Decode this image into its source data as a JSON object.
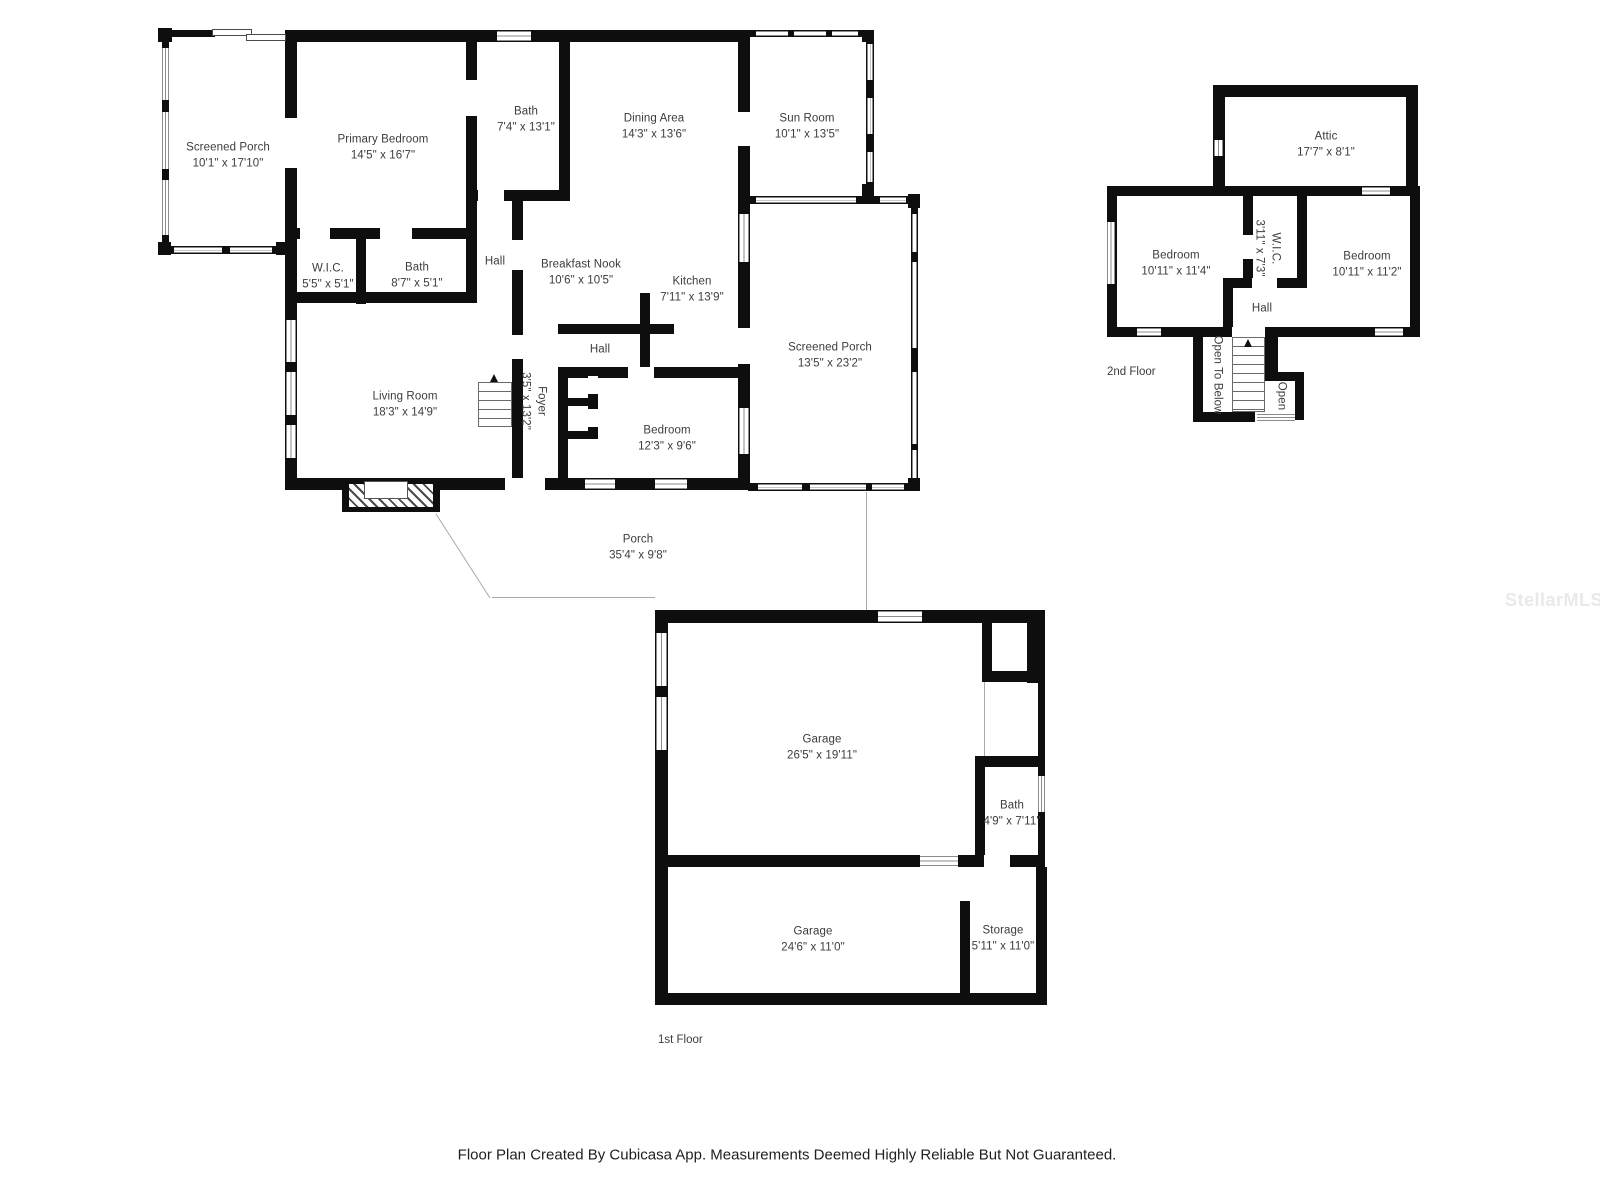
{
  "meta": {
    "watermark": "StellarMLS",
    "footer": "Floor Plan Created By Cubicasa App. Measurements Deemed Highly Reliable But Not Guaranteed."
  },
  "floors": [
    {
      "label": "1st Floor",
      "rooms": [
        {
          "name": "Screened Porch",
          "dims": "10'1\" x 17'10\""
        },
        {
          "name": "Primary Bedroom",
          "dims": "14'5\" x 16'7\""
        },
        {
          "name": "Bath",
          "dims": "7'4\" x 13'1\""
        },
        {
          "name": "Dining Area",
          "dims": "14'3\" x 13'6\""
        },
        {
          "name": "Sun Room",
          "dims": "10'1\" x 13'5\""
        },
        {
          "name": "W.I.C.",
          "dims": "5'5\" x 5'1\""
        },
        {
          "name": "Bath",
          "dims": "8'7\" x 5'1\""
        },
        {
          "name": "Hall",
          "dims": ""
        },
        {
          "name": "Breakfast Nook",
          "dims": "10'6\" x 10'5\""
        },
        {
          "name": "Kitchen",
          "dims": "7'11\" x 13'9\""
        },
        {
          "name": "Screened Porch",
          "dims": "13'5\" x 23'2\""
        },
        {
          "name": "Living Room",
          "dims": "18'3\" x 14'9\""
        },
        {
          "name": "Foyer",
          "dims": "3'5\" x 13'2\""
        },
        {
          "name": "Hall",
          "dims": ""
        },
        {
          "name": "Bedroom",
          "dims": "12'3\" x 9'6\""
        },
        {
          "name": "Porch",
          "dims": "35'4\" x 9'8\""
        },
        {
          "name": "Garage",
          "dims": "26'5\" x 19'11\""
        },
        {
          "name": "Bath",
          "dims": "4'9\" x 7'11\""
        },
        {
          "name": "Garage",
          "dims": "24'6\" x 11'0\""
        },
        {
          "name": "Storage",
          "dims": "5'11\" x 11'0\""
        }
      ]
    },
    {
      "label": "2nd Floor",
      "rooms": [
        {
          "name": "Attic",
          "dims": "17'7\" x 8'1\""
        },
        {
          "name": "Bedroom",
          "dims": "10'11\" x 11'4\""
        },
        {
          "name": "W.I.C.",
          "dims": "3'11\" x 7'3\""
        },
        {
          "name": "Bedroom",
          "dims": "10'11\" x 11'2\""
        },
        {
          "name": "Hall",
          "dims": ""
        },
        {
          "name": "Open To Below",
          "dims": ""
        },
        {
          "name": "Open",
          "dims": ""
        }
      ]
    }
  ]
}
